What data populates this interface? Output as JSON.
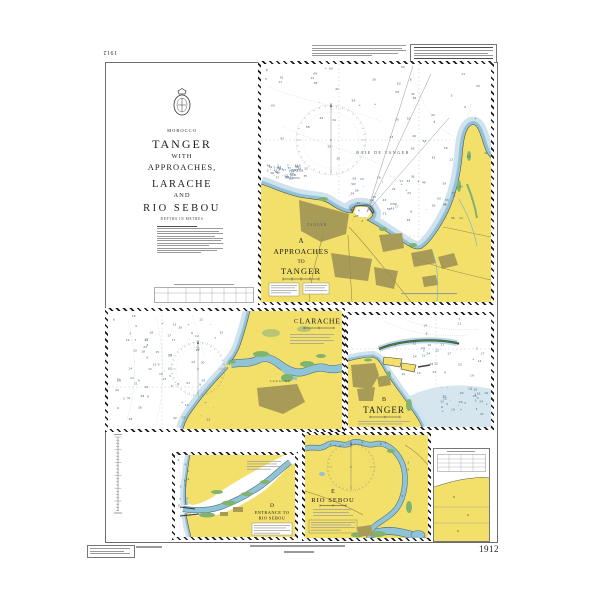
{
  "chart_number": {
    "bottom_right": "1912",
    "top_left_inverted": "1912"
  },
  "title_block": {
    "country": "MOROCCO",
    "title_lines": [
      "TANGER",
      "WITH",
      "APPROACHES,",
      "LARACHE",
      "AND",
      "RIO SEBOU"
    ],
    "depths_note": "DEPTHS IN METRES"
  },
  "panels": {
    "a": {
      "letter": "A",
      "title_lines": [
        "APPROACHES",
        "TO",
        "TANGER"
      ],
      "sea_label": "BAIE DE TANGER",
      "city_label": "TANGER"
    },
    "b": {
      "letter": "B",
      "title": "TANGER"
    },
    "c": {
      "letter": "C",
      "title": "LARACHE",
      "city_label": "LARACHE"
    },
    "d": {
      "letter": "D",
      "title_lines": [
        "ENTRANCE TO",
        "RIO SEBOU"
      ]
    },
    "e": {
      "letter": "E",
      "title": "RIO SEBOU"
    }
  },
  "colors": {
    "land": "#f2e06a",
    "shallow_water": "#93c2d8",
    "shoal_water": "#cfe2ed",
    "intertidal_green": "#7fb36e",
    "built_up_area": "#a89b58",
    "sea": "#ffffff"
  }
}
